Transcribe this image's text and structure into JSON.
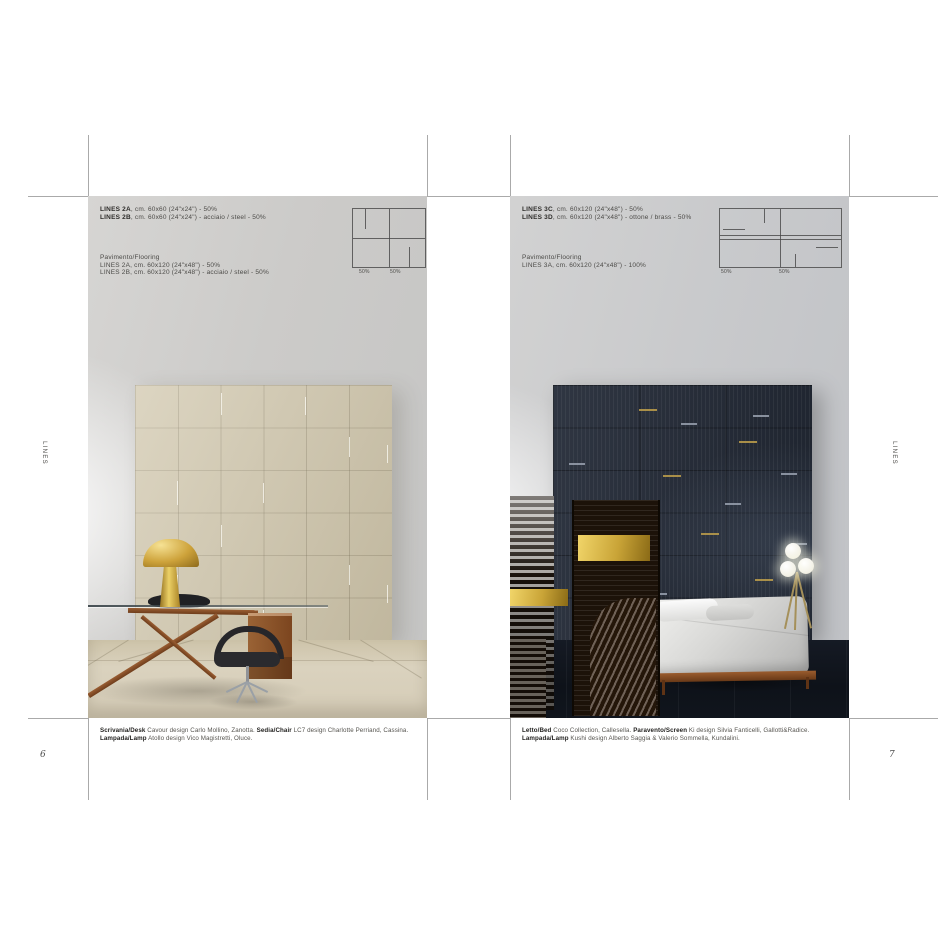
{
  "palette": {
    "page_gray": "#cbcac8",
    "crop_mark": "#9b9b9b",
    "beige_tile": "#cfc5aa",
    "beige_floor": "#d8cfba",
    "navy_tile": "#242b38",
    "navy_floor": "#10151d",
    "gold_accent": "#c9a437",
    "wood": "#8a4f2a",
    "text_dark": "#2d2c2a",
    "text_gray": "#56544f"
  },
  "left_page": {
    "side_label": "LINES",
    "page_number": "6",
    "spec_lines_1": [
      [
        {
          "t": "LINES 2A",
          "b": true
        },
        {
          "t": ", cm. 60x60 (24\"x24\") - 50%",
          "b": false
        }
      ],
      [
        {
          "t": "LINES 2B",
          "b": true
        },
        {
          "t": ", cm. 60x60 (24\"x24\") - acciaio / steel - 50%",
          "b": false
        }
      ]
    ],
    "spec_lines_2": [
      [
        {
          "t": "Pavimento/Flooring",
          "b": false
        }
      ],
      [
        {
          "t": "LINES 2A, cm. 60x120 (24\"x48\") - 50%",
          "b": false
        }
      ],
      [
        {
          "t": "LINES 2B, cm. 60x120 (24\"x48\") - acciaio / steel - 50%",
          "b": false
        }
      ]
    ],
    "diagram": {
      "labels": [
        "50%",
        "50%"
      ]
    },
    "caption": [
      {
        "t": "Scrivania/Desk",
        "b": true
      },
      {
        "t": " Cavour design Carlo Mollino, Zanotta. ",
        "b": false
      },
      {
        "t": "Sedia/Chair",
        "b": true
      },
      {
        "t": " LC7 design Charlotte Perriand, Cassina. ",
        "b": false
      },
      {
        "t": "Lampada/Lamp",
        "b": true
      },
      {
        "t": " Atollo design Vico Magistretti, Oluce.",
        "b": false
      }
    ]
  },
  "right_page": {
    "side_label": "LINES",
    "page_number": "7",
    "spec_lines_1": [
      [
        {
          "t": "LINES 3C",
          "b": true
        },
        {
          "t": ", cm. 60x120 (24\"x48\") - 50%",
          "b": false
        }
      ],
      [
        {
          "t": "LINES 3D",
          "b": true
        },
        {
          "t": ", cm. 60x120 (24\"x48\") - ottone / brass - 50%",
          "b": false
        }
      ]
    ],
    "spec_lines_2": [
      [
        {
          "t": "Pavimento/Flooring",
          "b": false
        }
      ],
      [
        {
          "t": "LINES 3A, cm. 60x120 (24\"x48\") - 100%",
          "b": false
        }
      ]
    ],
    "diagram": {
      "labels": [
        "50%",
        "50%"
      ]
    },
    "caption": [
      {
        "t": "Letto/Bed",
        "b": true
      },
      {
        "t": " Coco Collection, Callesella. ",
        "b": false
      },
      {
        "t": "Paravento/Screen",
        "b": true
      },
      {
        "t": " Ki design Silvia Fanticelli, Gallotti&Radice. ",
        "b": false
      },
      {
        "t": "Lampada/Lamp",
        "b": true
      },
      {
        "t": " Kushi design Alberto Saggia & Valerio Sommella, Kundalini.",
        "b": false
      }
    ]
  }
}
